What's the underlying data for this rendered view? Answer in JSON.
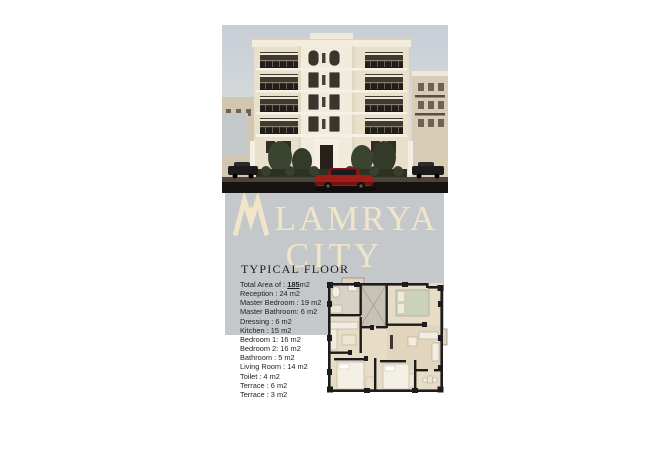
{
  "colors": {
    "band_gray": "#c5c8ca",
    "logo_cream": "#f0e5c9",
    "building_beige": "#e9e0cc",
    "red_car": "#a01e1a"
  },
  "brand": {
    "line1": "LAMRYA",
    "line2": "CITY"
  },
  "section": {
    "title": "TYPICAL FLOOR"
  },
  "specs": {
    "total": {
      "prefix": "Total Area of :",
      "value": "185",
      "unit": "m2"
    },
    "rows": [
      "Reception : 24 m2",
      "Master Bedroom : 19 m2",
      "Master Bathroom: 6 m2",
      "Dressing : 6 m2",
      "Kitchen : 15 m2",
      "Bedroom 1: 16 m2",
      "Bedroom 2: 16 m2",
      "Bathroom : 5 m2",
      "Living Room : 14 m2",
      "Toilet : 4 m2",
      "Terrace : 6 m2",
      "Terrace : 3 m2"
    ]
  }
}
